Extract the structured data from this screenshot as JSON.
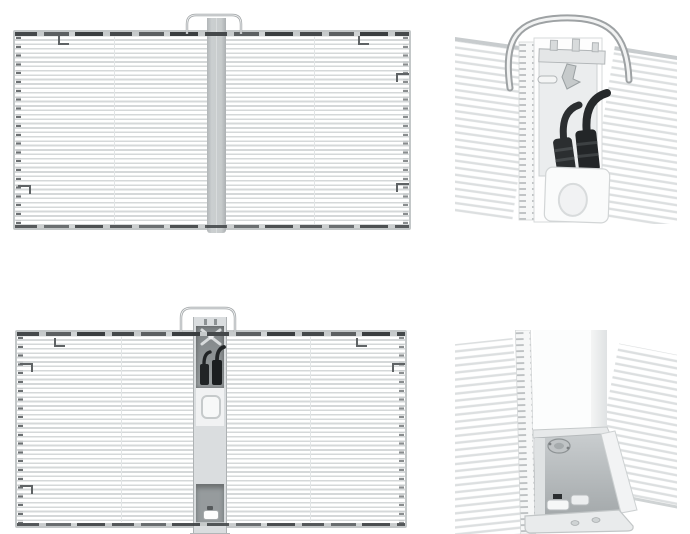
{
  "page": {
    "background_color": "#ffffff",
    "description": "Four grayscale product renders of a transparent LED mesh display panel, arranged in a two by two grid"
  },
  "colors": {
    "background": "#ffffff",
    "louver_stripe": "#d5d8d9",
    "detail_stripe": "#dcdfe0",
    "frame": "#c3c7c8",
    "rail_dark": "#45494b",
    "center_bar": "#c7cbcc",
    "compartment_dark": "#8d9294",
    "connector_black": "#2b2e30",
    "handle_stroke": "#9ea2a4",
    "hook_mark": "#5f6365"
  },
  "figures": {
    "panel_top": {
      "label": "Transparent LED panel, rear full view with closed center hanging bar and top carry handle"
    },
    "detail_top": {
      "label": "Close-up of top carry handle, mounting plate and two black aviation cable connectors"
    },
    "panel_bottom": {
      "label": "Transparent LED panel, rear full view with opened center cable compartment and bottom foot"
    },
    "detail_bottom": {
      "label": "Close-up of bottom corner with open connector compartment and support foot"
    }
  },
  "parts": {
    "carry_handle": "carry-handle",
    "cable_connector": "aviation-cable-connector",
    "junction_box": "junction-box",
    "led_louvers": "led-louver-strips",
    "hanging_bar": "center-hanging-bar",
    "foot": "support-foot"
  }
}
